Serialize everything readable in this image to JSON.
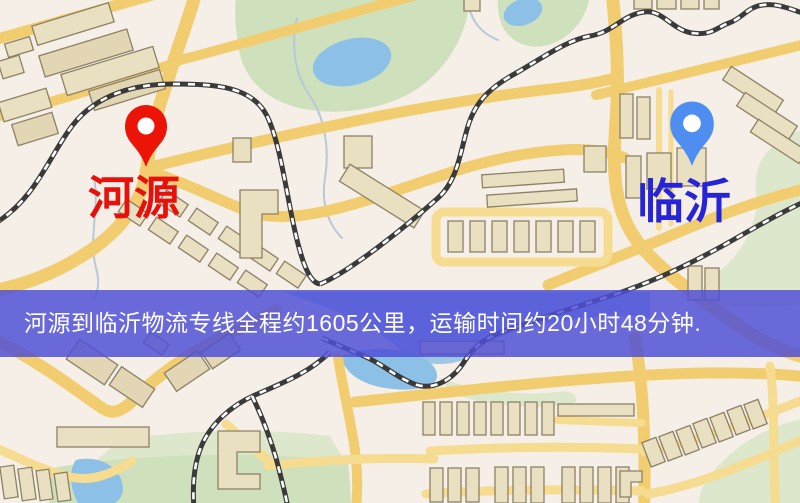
{
  "window": {
    "width": 800,
    "height": 503,
    "kind": "map-screenshot"
  },
  "banner": {
    "text": "河源到临沂物流专线全程约1605公里，运输时间约20小时48分钟.",
    "background_color": "#4f4fd7",
    "text_color": "#ffffff"
  },
  "route": {
    "origin": "河源",
    "destination": "临沂",
    "service": "物流专线",
    "distance_text": "约1605公里",
    "duration_text": "约20小时48分钟"
  },
  "markers": {
    "origin": {
      "label": "河源",
      "pin_color": "#eb1407",
      "label_color": "#e8100a"
    },
    "destination": {
      "label": "临沂",
      "pin_color": "#4e8ef1",
      "label_color": "#2524d8"
    }
  },
  "map": {
    "colors": {
      "background": "#f5efe8",
      "road": "#f2cd6f",
      "road_minor": "#f6dc90",
      "building_fill": "#e9dfc1",
      "building_stroke": "#8d8165",
      "park_green": "#cfe0bc",
      "water_blue": "#8cc0e6",
      "railway": "#3a3a3a"
    }
  }
}
